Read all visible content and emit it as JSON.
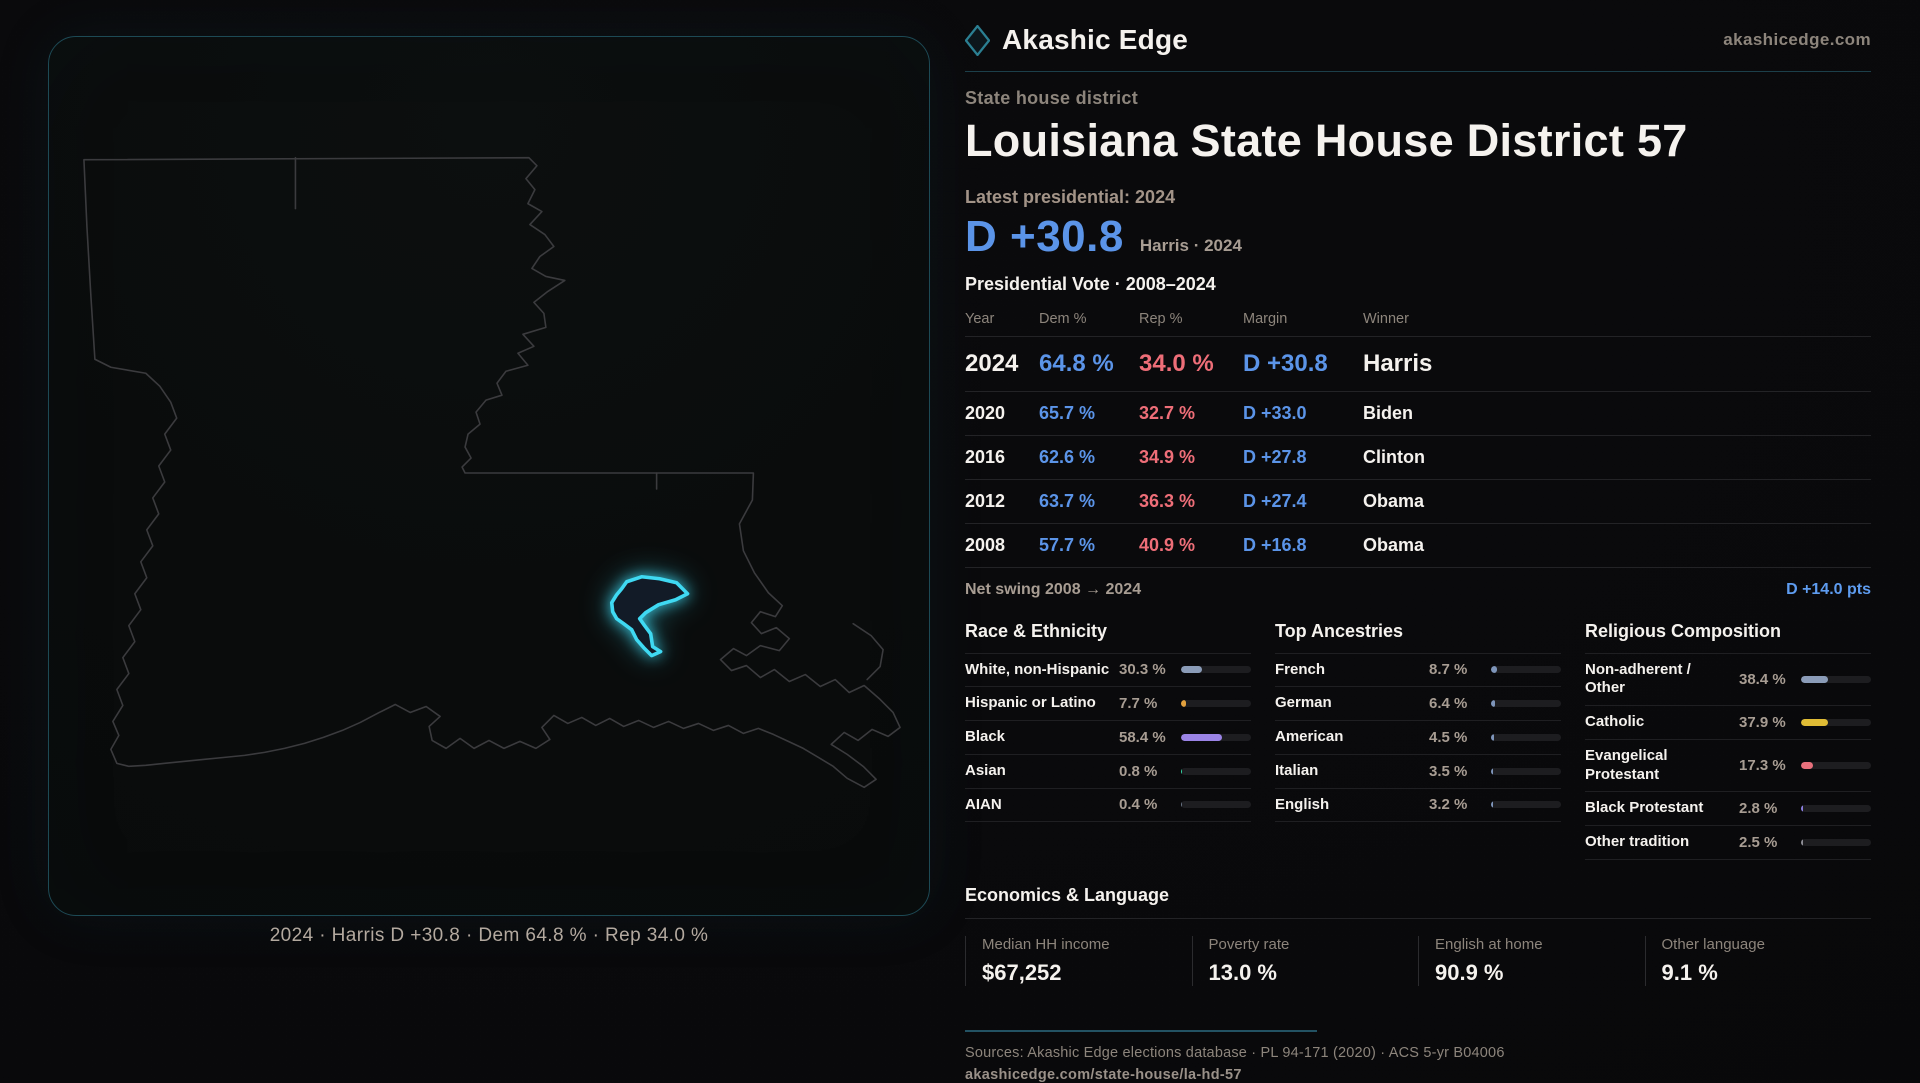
{
  "brand": {
    "name": "Akashic Edge",
    "site": "akashicedge.com"
  },
  "header": {
    "kicker": "State house district",
    "title": "Louisiana State House District 57"
  },
  "latest": {
    "label": "Latest presidential: 2024",
    "margin": "D +30.8",
    "sub": "Harris · 2024"
  },
  "table": {
    "title": "Presidential Vote · 2008–2024",
    "columns": [
      "Year",
      "Dem %",
      "Rep %",
      "Margin",
      "Winner"
    ],
    "rows": [
      {
        "year": "2024",
        "dem": "64.8 %",
        "rep": "34.0 %",
        "margin": "D +30.8",
        "winner": "Harris",
        "emphasis": true
      },
      {
        "year": "2020",
        "dem": "65.7 %",
        "rep": "32.7 %",
        "margin": "D +33.0",
        "winner": "Biden",
        "emphasis": false
      },
      {
        "year": "2016",
        "dem": "62.6 %",
        "rep": "34.9 %",
        "margin": "D +27.8",
        "winner": "Clinton",
        "emphasis": false
      },
      {
        "year": "2012",
        "dem": "63.7 %",
        "rep": "36.3 %",
        "margin": "D +27.4",
        "winner": "Obama",
        "emphasis": false
      },
      {
        "year": "2008",
        "dem": "57.7 %",
        "rep": "40.9 %",
        "margin": "D +16.8",
        "winner": "Obama",
        "emphasis": false
      }
    ]
  },
  "net_swing": {
    "label": "Net swing 2008 → 2024",
    "value": "D +14.0 pts"
  },
  "demographics": {
    "columns": [
      {
        "title": "Race & Ethnicity",
        "rows": [
          {
            "label": "White, non-Hispanic",
            "value": "30.3 %",
            "pct": 30.3,
            "color": "#8b9cb8"
          },
          {
            "label": "Hispanic or Latino",
            "value": "7.7 %",
            "pct": 7.7,
            "color": "#e3a13e"
          },
          {
            "label": "Black",
            "value": "58.4 %",
            "pct": 58.4,
            "color": "#9b84e6"
          },
          {
            "label": "Asian",
            "value": "0.8 %",
            "pct": 0.8,
            "color": "#35d6a5"
          },
          {
            "label": "AIAN",
            "value": "0.4 %",
            "pct": 0.4,
            "color": "#6b7687"
          }
        ]
      },
      {
        "title": "Top Ancestries",
        "rows": [
          {
            "label": "French",
            "value": "8.7 %",
            "pct": 8.7,
            "color": "#7e95ba"
          },
          {
            "label": "German",
            "value": "6.4 %",
            "pct": 6.4,
            "color": "#7e95ba"
          },
          {
            "label": "American",
            "value": "4.5 %",
            "pct": 4.5,
            "color": "#7e95ba"
          },
          {
            "label": "Italian",
            "value": "3.5 %",
            "pct": 3.5,
            "color": "#7e95ba"
          },
          {
            "label": "English",
            "value": "3.2 %",
            "pct": 3.2,
            "color": "#7e95ba"
          }
        ]
      },
      {
        "title": "Religious Composition",
        "rows": [
          {
            "label": "Non-adherent / Other",
            "value": "38.4 %",
            "pct": 38.4,
            "color": "#8b9cb8"
          },
          {
            "label": "Catholic",
            "value": "37.9 %",
            "pct": 37.9,
            "color": "#e0bc35"
          },
          {
            "label": "Evangelical Protestant",
            "value": "17.3 %",
            "pct": 17.3,
            "color": "#e8707c"
          },
          {
            "label": "Black Protestant",
            "value": "2.8 %",
            "pct": 2.8,
            "color": "#8b7fe0"
          },
          {
            "label": "Other tradition",
            "value": "2.5 %",
            "pct": 2.5,
            "color": "#8e8e96"
          }
        ]
      }
    ]
  },
  "economics": {
    "title": "Economics & Language",
    "stats": [
      {
        "label": "Median HH income",
        "value": "$67,252"
      },
      {
        "label": "Poverty rate",
        "value": "13.0 %"
      },
      {
        "label": "English at home",
        "value": "90.9 %"
      },
      {
        "label": "Other language",
        "value": "9.1 %"
      }
    ]
  },
  "footer": {
    "sources": "Sources: Akashic Edge elections database · PL 94-171 (2020) · ACS 5-yr B04006",
    "permalink": "akashicedge.com/state-house/la-hd-57"
  },
  "map": {
    "caption": "2024 · Harris D +30.8 · Dem 64.8 % · Rep 34.0 %"
  },
  "colors": {
    "dem-blue": "#5b94e8",
    "rep-red": "#ee6e78",
    "swing-blue": "#5e9cf0",
    "accent-teal": "#2b7f92",
    "district-cyan": "#3fd9f2",
    "panel-border-teal": "#1d4a55"
  }
}
